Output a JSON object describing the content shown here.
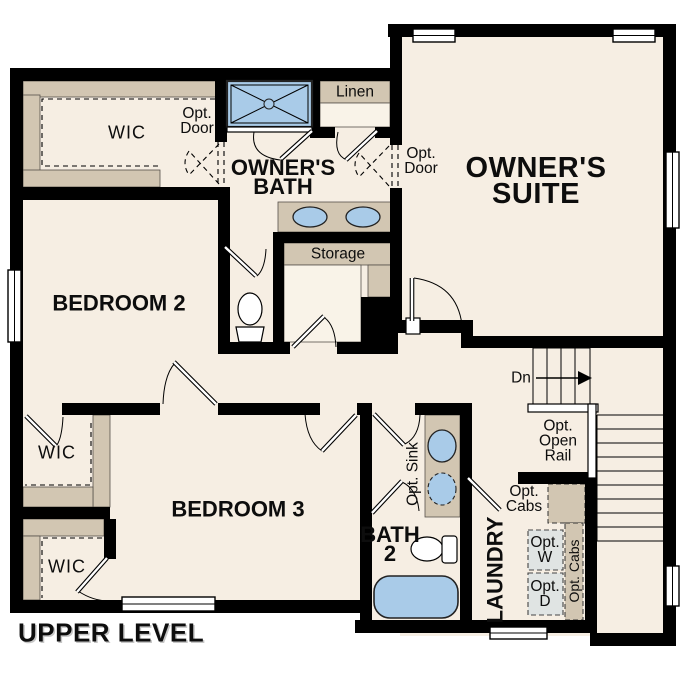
{
  "plan_title": "UPPER LEVEL",
  "rooms": {
    "owners_suite": {
      "line1": "OWNER'S",
      "line2": "SUITE"
    },
    "owners_bath": {
      "line1": "OWNER'S",
      "line2": "BATH"
    },
    "bedroom2": {
      "label": "BEDROOM 2"
    },
    "bedroom3": {
      "label": "BEDROOM 3"
    },
    "bath2": {
      "line1": "BATH",
      "line2": "2"
    },
    "laundry": {
      "label": "LAUNDRY"
    },
    "wic_owners": {
      "label": "WIC"
    },
    "wic_bedroom2": {
      "label": "WIC"
    },
    "wic_bedroom3": {
      "label": "WIC"
    },
    "linen": {
      "label": "Linen"
    },
    "storage": {
      "label": "Storage"
    }
  },
  "annotations": {
    "opt_door_wic": {
      "line1": "Opt.",
      "line2": "Door"
    },
    "opt_door_suite": {
      "line1": "Opt.",
      "line2": "Door"
    },
    "opt_sink": {
      "label": "Opt. Sink"
    },
    "opt_open_rail": {
      "line1": "Opt.",
      "line2": "Open",
      "line3": "Rail"
    },
    "opt_cabs_laundry": {
      "line1": "Opt.",
      "line2": "Cabs"
    },
    "opt_cabs_side": {
      "label": "Opt. Cabs"
    },
    "opt_washer": {
      "line1": "Opt.",
      "line2": "W"
    },
    "opt_dryer": {
      "line1": "Opt.",
      "line2": "D"
    },
    "stairs_down": {
      "label": "Dn"
    }
  },
  "colors": {
    "floor": "#f6eee3",
    "wall": "#000000",
    "shelf_tan": "#d2c6b2",
    "fixture_blue": "#a9cbe8",
    "appliance_gray": "#e0e4e3",
    "page": "#ffffff"
  }
}
